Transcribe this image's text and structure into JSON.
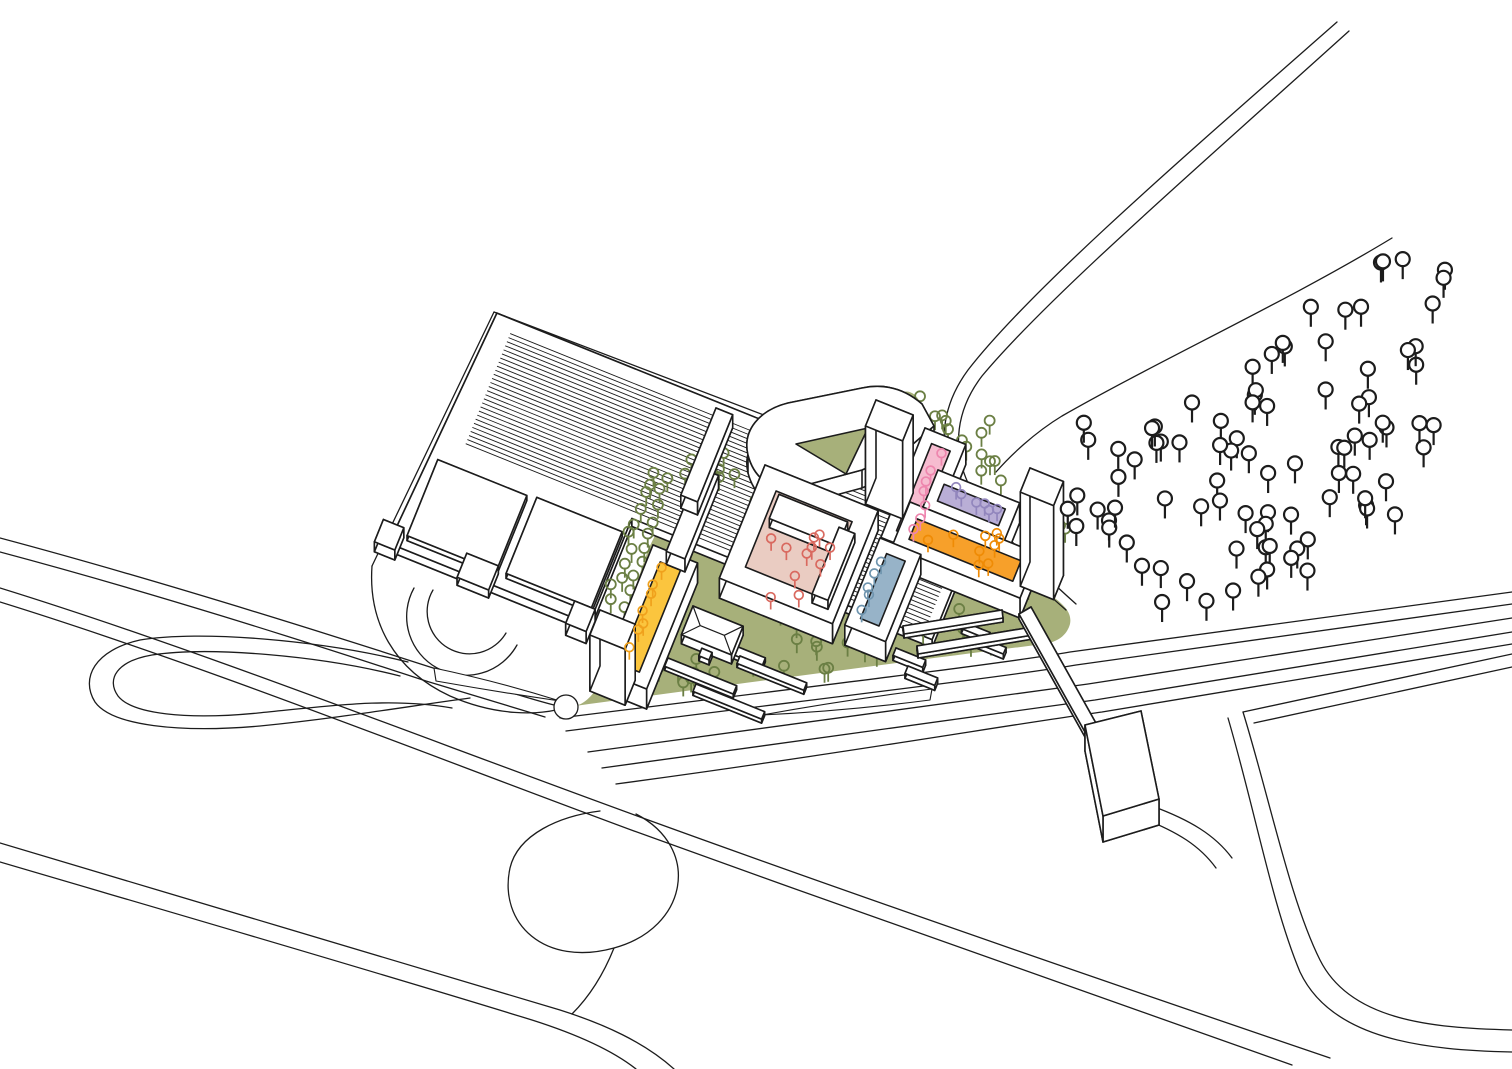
{
  "canvas": {
    "width": 1512,
    "height": 1069,
    "background": "#ffffff",
    "ink": "#1c1c1c"
  },
  "basis": {
    "u": [
      0.927,
      0.374
    ],
    "v": [
      -0.374,
      0.927
    ]
  },
  "palette": {
    "grass": "#a7b07a",
    "court_salmon": "#eaccc2",
    "court_pink": "#f6bcd0",
    "court_purple": "#b9aed6",
    "court_orange": "#f7a02a",
    "court_yellow": "#fbc53e",
    "court_blue": "#97b3c8",
    "tree_site_green": "#6b7f44",
    "tree_field_black": "#1c1c1c",
    "tree_salmon": "#d9695f",
    "tree_pink": "#ee86ae",
    "tree_purple": "#9286bd",
    "tree_orange": "#ef8b05",
    "tree_yellow": "#f0a11c",
    "tree_blue": "#6e94ae",
    "building_fill": "#ffffff"
  },
  "green": {
    "d": "M 575 706 C 720 686 910 661 1044 644 C 1058 642 1067 635 1070 624 C 1072 614 1066 606 1052 596 C 1014 565 982 532 962 496 C 945 460 932 428 920 402 C 916 394 910 390 902 392 L 878 398 C 848 408 818 424 790 444 C 764 462 736 480 706 492 C 678 503 658 522 646 556 C 632 596 618 644 602 678 C 594 696 584 704 575 706 Z"
  },
  "roads": [
    {
      "name": "street-north-a",
      "d": "M 0 538 C 150 578 300 625 430 667 C 478 682 522 697 554 705"
    },
    {
      "name": "street-north-b",
      "d": "M 0 552 C 150 592 298 639 426 681 C 468 694 508 706 545 717"
    },
    {
      "name": "highway-a",
      "d": "M 0 588 C 200 650 420 737 640 817 C 860 897 1080 973 1330 1058"
    },
    {
      "name": "highway-b",
      "d": "M 0 602 C 200 664 418 751 634 831 C 850 909 1060 984 1292 1065"
    },
    {
      "name": "highway-south-a",
      "d": "M 0 843 C 180 898 380 955 560 1010 C 604 1024 644 1042 674 1069"
    },
    {
      "name": "highway-south-b",
      "d": "M 0 862 C 170 912 360 967 532 1020 C 576 1034 612 1050 636 1069"
    },
    {
      "name": "ramp-loop",
      "d": "M 636 814 C 702 848 688 928 614 948 C 545 967 498 924 510 868 C 518 834 560 816 600 811"
    },
    {
      "name": "ramp-loop-tail",
      "d": "M 614 948 C 602 978 588 998 572 1014"
    },
    {
      "name": "teardrop-outer",
      "d": "M 408 662 C 320 640 200 630 140 640 C 95 650 80 678 95 702 C 112 726 180 733 260 726 C 340 718 410 706 470 698"
    },
    {
      "name": "teardrop-inner",
      "d": "M 400 676 C 322 656 210 646 152 655 C 117 661 106 679 118 696 C 132 714 186 720 258 713 C 330 706 390 697 452 708"
    },
    {
      "name": "corridor-1",
      "d": "M 560 718 C 800 688 1000 664 1070 652 L 1512 592"
    },
    {
      "name": "corridor-2",
      "d": "M 566 731 C 800 701 1005 677 1076 665 L 1512 604"
    },
    {
      "name": "corridor-3",
      "d": "M 588 752 C 820 722 1010 696 1088 684 L 1512 618"
    },
    {
      "name": "corridor-4",
      "d": "M 602 768 C 830 738 1020 710 1095 700 L 1512 632"
    },
    {
      "name": "corridor-5",
      "d": "M 616 784 C 840 754 1026 722 1102 712 L 1512 644"
    },
    {
      "name": "riverside-road-a",
      "d": "M 1337 22 C 1180 160 1030 290 968 370 C 940 408 938 448 955 487 C 975 525 1020 570 1066 610"
    },
    {
      "name": "riverside-road-b",
      "d": "M 1349 31 C 1195 170 1048 297 982 376 C 956 410 952 448 968 483 C 988 520 1030 563 1076 604"
    },
    {
      "name": "slope-path",
      "d": "M 1392 238 C 1290 300 1160 360 1062 416 C 1034 433 1010 456 996 472"
    },
    {
      "name": "embankment-top-a",
      "d": "M 1243 712 L 1512 654"
    },
    {
      "name": "embankment-top-b",
      "d": "M 1254 723 L 1512 667"
    },
    {
      "name": "embankment-edge-a",
      "d": "M 1243 712 C 1270 800 1290 900 1320 960 C 1350 1020 1430 1028 1512 1030"
    },
    {
      "name": "embankment-edge-b",
      "d": "M 1228 718 C 1255 810 1272 905 1300 972 C 1332 1040 1425 1050 1512 1052"
    },
    {
      "name": "landing-drive-a",
      "d": "M 1152 806 C 1190 820 1215 835 1232 858"
    },
    {
      "name": "landing-drive-b",
      "d": "M 1142 818 C 1178 832 1200 846 1216 868"
    },
    {
      "name": "parcel-left-curve",
      "d": "M 372 566 C 368 622 394 670 450 696 C 498 717 538 714 556 710"
    },
    {
      "name": "parcel-edge-left",
      "d": "M 372 566 L 494 312"
    },
    {
      "name": "parcel-edge-top",
      "d": "M 494 312 L 1018 512"
    },
    {
      "name": "parking-arc-outer",
      "d": "M 414 588 A 58 58 0 0 0 517 645"
    },
    {
      "name": "parking-arc-inner",
      "d": "M 433 590 A 42 42 0 0 0 506 633"
    }
  ],
  "medians": [
    {
      "name": "merge-island-west",
      "d": "M 434 668 Q 500 682 560 701 Q 498 692 436 681 Z"
    },
    {
      "name": "merge-island-east",
      "d": "M 932 689 Q 845 700 762 715 Q 846 711 930 700 Z"
    }
  ],
  "roundabout": {
    "cx": 566,
    "cy": 707,
    "r": 12
  },
  "hall": {
    "N": [
      505,
      325
    ],
    "outline": [
      [
        -12,
        -8
      ],
      [
        514,
        -8
      ],
      [
        514,
        132
      ],
      [
        190,
        132
      ],
      [
        190,
        246
      ],
      [
        -26,
        246
      ]
    ],
    "outline_h": 8,
    "hatch": {
      "a0": 8,
      "a1": 504,
      "v0": 6,
      "v1": 128,
      "step": 4.4
    },
    "panels": [
      {
        "a": -12,
        "v": 150,
        "ul": 96,
        "vl": 82,
        "h": 5
      },
      {
        "a": 94,
        "v": 148,
        "ul": 92,
        "vl": 82,
        "h": 5
      }
    ],
    "annex_boxes": [
      {
        "a": 50,
        "v": 226,
        "ul": 34,
        "vl": 26,
        "h": 8
      },
      {
        "a": -40,
        "v": 226,
        "ul": 22,
        "vl": 24,
        "h": 10
      },
      {
        "a": 168,
        "v": 230,
        "ul": 22,
        "vl": 24,
        "h": 12
      }
    ]
  },
  "buildings": {
    "wedge": {
      "outer": "M 748 455 C 742 430 760 410 788 403 L 862 388 C 886 383 906 390 922 404 L 934 426 L 906 450 L 862 470 L 795 488 C 772 492 754 478 748 455 Z",
      "hole": "M 796 444 L 868 428 L 846 474 Z",
      "h": 18
    },
    "rings": [
      {
        "name": "courtyard-salmon-ring",
        "N": [
          765,
          465
        ],
        "ul": 122,
        "vl": 122,
        "t": 20,
        "fill": "court_salmon",
        "bars": [
          {
            "a": 24,
            "v": 22,
            "ul": 74,
            "vl": 26,
            "h": 9
          },
          {
            "a": 92,
            "v": 30,
            "ul": 17,
            "vl": 72,
            "h": 9
          }
        ]
      },
      {
        "name": "courtyard-pink-ring",
        "N": [
          925,
          428
        ],
        "ul": 44,
        "vl": 118,
        "t": 12,
        "fill": "court_pink",
        "bars": []
      },
      {
        "name": "courtyard-purple-ring",
        "N": [
          938,
          470
        ],
        "ul": 88,
        "vl": 40,
        "t": 11,
        "fill": "court_purple",
        "bars": []
      },
      {
        "name": "courtyard-orange-ring",
        "N": [
          910,
          502
        ],
        "ul": 138,
        "vl": 48,
        "t": 13,
        "fill": "court_orange",
        "bars": []
      },
      {
        "name": "courtyard-blue-ring",
        "N": [
          880,
          538
        ],
        "ul": 44,
        "vl": 94,
        "t": 12,
        "fill": "court_blue",
        "bars": []
      },
      {
        "name": "courtyard-yellow-ring",
        "N": [
          653,
          545
        ],
        "ul": 48,
        "vl": 136,
        "t": 13,
        "fill": "court_yellow",
        "bars": []
      }
    ],
    "towers": [
      {
        "name": "tower-north",
        "N": [
          876,
          400
        ],
        "ul": 40,
        "vl": 28,
        "h": 78
      },
      {
        "name": "tower-east",
        "N": [
          1030,
          468
        ],
        "ul": 36,
        "vl": 26,
        "h": 94
      },
      {
        "name": "tower-west",
        "N": [
          600,
          610
        ],
        "ul": 38,
        "vl": 27,
        "h": 56
      }
    ],
    "slabs": [
      {
        "name": "linear-bar-1",
        "N": [
          700,
          468
        ],
        "ul": 20,
        "vl": 90,
        "h": 13
      },
      {
        "name": "linear-bar-2",
        "N": [
          716,
          408
        ],
        "ul": 18,
        "vl": 94,
        "h": 13
      },
      {
        "name": "bench-1",
        "N": [
          706,
          634
        ],
        "ul": 64,
        "vl": 9,
        "h": 4
      },
      {
        "name": "bench-2",
        "N": [
          668,
          658
        ],
        "ul": 74,
        "vl": 9,
        "h": 4
      },
      {
        "name": "bench-3",
        "N": [
          740,
          656
        ],
        "ul": 72,
        "vl": 8,
        "h": 4
      },
      {
        "name": "bench-4",
        "N": [
          696,
          684
        ],
        "ul": 74,
        "vl": 8,
        "h": 4
      },
      {
        "name": "stair-stub-1",
        "N": [
          896,
          648
        ],
        "ul": 32,
        "vl": 8,
        "h": 5
      },
      {
        "name": "stair-stub-2",
        "N": [
          908,
          666
        ],
        "ul": 32,
        "vl": 8,
        "h": 5
      },
      {
        "name": "stair-stub-3",
        "N": [
          964,
          622
        ],
        "ul": 28,
        "vl": 7,
        "h": 5
      },
      {
        "name": "stair-stub-4",
        "N": [
          980,
          637
        ],
        "ul": 28,
        "vl": 7,
        "h": 5
      }
    ],
    "pavilion": {
      "N": [
        693,
        606
      ],
      "ul": 54,
      "vl": 31,
      "h": 9,
      "sign": {
        "a": 24,
        "v": 36,
        "ul": 11,
        "vl": 8,
        "h": 5
      }
    }
  },
  "platforms": [
    {
      "name": "platform-1",
      "pts": [
        [
          903,
          626
        ],
        [
          1002,
          610
        ],
        [
          1003,
          618
        ],
        [
          904,
          634
        ]
      ],
      "h": 4
    },
    {
      "name": "platform-2",
      "pts": [
        [
          917,
          646
        ],
        [
          1032,
          627
        ],
        [
          1033,
          635
        ],
        [
          918,
          654
        ]
      ],
      "h": 4
    }
  ],
  "bridge": {
    "deck": {
      "pts": [
        [
          1019,
          614
        ],
        [
          1031,
          607
        ],
        [
          1097,
          725
        ],
        [
          1085,
          732
        ]
      ],
      "h": 5
    },
    "landing": {
      "pts": [
        [
          1085,
          725
        ],
        [
          1141,
          711
        ],
        [
          1159,
          799
        ],
        [
          1103,
          816
        ]
      ],
      "h": 26
    }
  },
  "trees": {
    "field": {
      "poly": [
        [
          1040,
          430
        ],
        [
          1180,
          390
        ],
        [
          1290,
          318
        ],
        [
          1398,
          248
        ],
        [
          1448,
          262
        ],
        [
          1452,
          356
        ],
        [
          1430,
          470
        ],
        [
          1396,
          540
        ],
        [
          1300,
          580
        ],
        [
          1190,
          610
        ],
        [
          1105,
          598
        ],
        [
          1070,
          540
        ]
      ],
      "n": 92,
      "r": 7,
      "stem": 13,
      "lw": 2.2,
      "seed": 7,
      "color": "tree_field_black",
      "fill": "#ffffff"
    },
    "site_patches": [
      {
        "cx": 712,
        "cy": 472,
        "w": 64,
        "h": 56,
        "n": 9
      },
      {
        "cx": 760,
        "cy": 505,
        "w": 44,
        "h": 36,
        "n": 5
      },
      {
        "cx": 962,
        "cy": 442,
        "w": 80,
        "h": 60,
        "n": 8
      },
      {
        "cx": 1052,
        "cy": 560,
        "w": 56,
        "h": 76,
        "n": 6
      },
      {
        "cx": 700,
        "cy": 666,
        "w": 110,
        "h": 48,
        "n": 9
      },
      {
        "cx": 838,
        "cy": 646,
        "w": 110,
        "h": 52,
        "n": 10
      },
      {
        "cx": 958,
        "cy": 624,
        "w": 86,
        "h": 38,
        "n": 7
      },
      {
        "cx": 640,
        "cy": 672,
        "w": 40,
        "h": 28,
        "n": 4
      },
      {
        "cx": 884,
        "cy": 408,
        "w": 40,
        "h": 22,
        "n": 4
      },
      {
        "cx": 805,
        "cy": 610,
        "w": 60,
        "h": 30,
        "n": 5
      }
    ],
    "site_rows": [
      {
        "from": [
          654,
          470
        ],
        "to": [
          610,
          600
        ],
        "n": 11,
        "jitter": 4
      },
      {
        "from": [
          668,
          478
        ],
        "to": [
          624,
          606
        ],
        "n": 10,
        "jitter": 4
      },
      {
        "from": [
          925,
          400
        ],
        "to": [
          1005,
          478
        ],
        "n": 7,
        "jitter": 5
      }
    ],
    "site_style": {
      "r": 5,
      "stem": 9,
      "lw": 1.8,
      "seed": 11,
      "color": "tree_site_green",
      "fill": "none"
    },
    "courtyard": [
      {
        "type": "patch",
        "cx": 798,
        "cy": 566,
        "w": 66,
        "h": 64,
        "n": 11,
        "color": "tree_salmon"
      },
      {
        "type": "row",
        "from": [
          938,
          456
        ],
        "to": [
          912,
          526
        ],
        "n": 7,
        "jitter": 5,
        "color": "tree_pink"
      },
      {
        "type": "row",
        "from": [
          954,
          490
        ],
        "to": [
          1000,
          510
        ],
        "n": 6,
        "jitter": 5,
        "color": "tree_purple"
      },
      {
        "type": "patch",
        "cx": 972,
        "cy": 550,
        "w": 90,
        "h": 34,
        "n": 9,
        "color": "tree_orange"
      },
      {
        "type": "row",
        "from": [
          660,
          570
        ],
        "to": [
          632,
          646
        ],
        "n": 7,
        "jitter": 4,
        "color": "tree_yellow"
      },
      {
        "type": "row",
        "from": [
          880,
          564
        ],
        "to": [
          860,
          610
        ],
        "n": 5,
        "jitter": 4,
        "color": "tree_blue"
      }
    ],
    "courtyard_style": {
      "r": 4.4,
      "stem": 8,
      "lw": 1.7,
      "seed": 23,
      "fill": "none"
    }
  },
  "stroke_widths": {
    "road": 1.3,
    "building": 1.6,
    "hatch": 0.9
  }
}
